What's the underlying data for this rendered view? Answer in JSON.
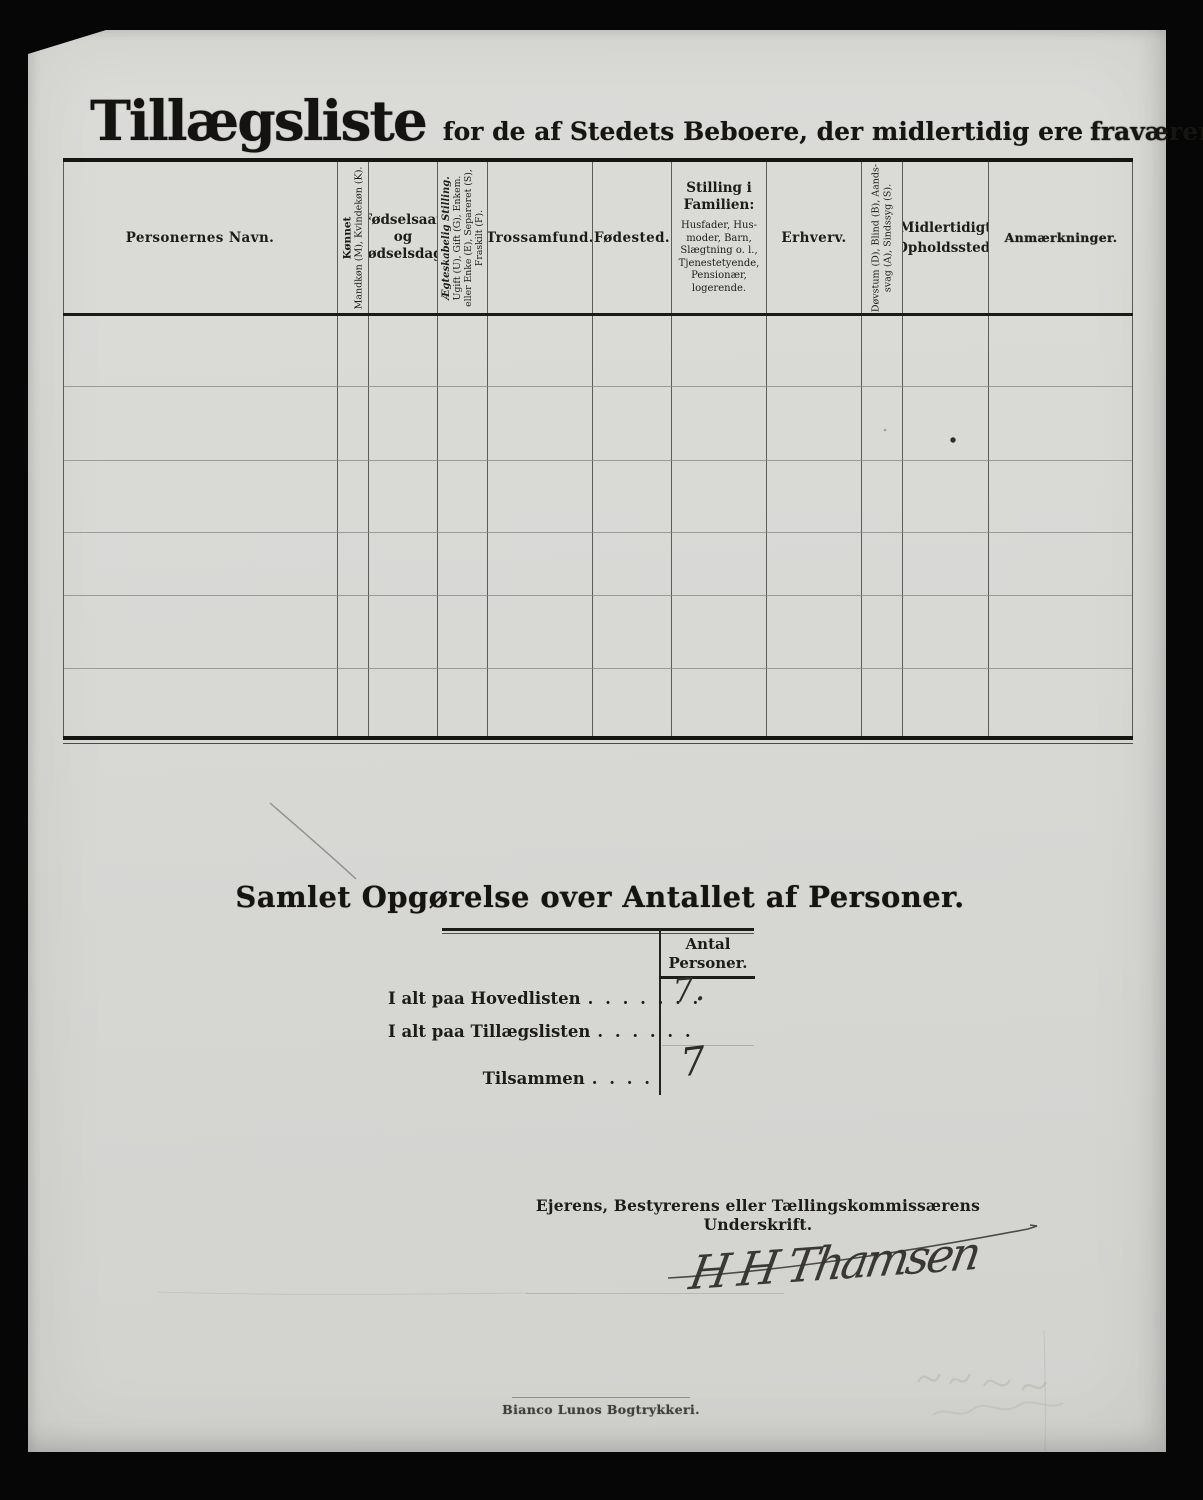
{
  "document": {
    "title": "Tillægsliste",
    "subtitle": "for de af Stedets Beboere, der midlertidig ere",
    "subtitle_emphasis": "fraværende."
  },
  "table": {
    "headers": {
      "name": "Personernes Navn.",
      "sex_title": "Kønnet",
      "sex_detail": "Mandkøn (M), Kvindekøn (K).",
      "birth_line1": "Fødselsaar",
      "birth_line2": "og",
      "birth_line3": "Fødselsdag.",
      "marital_title": "Ægteskabelig Stilling.",
      "marital_line1": "Ugift (U), Gift (G), Enkem.",
      "marital_line2": "eller Enke (E), Separeret (S),",
      "marital_line3": "Fraskilt (F).",
      "religion": "Trossamfund.",
      "birthplace": "Fødested.",
      "family_title_line1": "Stilling i",
      "family_title_line2": "Familien:",
      "family_detail_line1": "Husfader, Hus-",
      "family_detail_line2": "moder, Barn,",
      "family_detail_line3": "Slægtning o. l.,",
      "family_detail_line4": "Tjenestetyende,",
      "family_detail_line5": "Pensionær,",
      "family_detail_line6": "logerende.",
      "occupation": "Erhverv.",
      "disability_line1": "Døvstum (D), Blind (B), Aands-",
      "disability_line2": "svag (A), Sindssyg (S).",
      "temp_residence_line1": "Midlertidigt",
      "temp_residence_line2": "Opholdssted.",
      "remarks": "Anmærkninger."
    },
    "body_rows": 6,
    "body_cols": 11
  },
  "summary": {
    "heading": "Samlet Opgørelse over Antallet af Personer.",
    "col_header_line1": "Antal",
    "col_header_line2": "Personer.",
    "rows": [
      {
        "label": "I alt paa Hovedlisten",
        "dots": ". . . . . . .",
        "value": "7."
      },
      {
        "label": "I alt paa Tillægslisten",
        "dots": ". . . . . .",
        "value": ""
      },
      {
        "label": "Tilsammen",
        "dots": ". . . .",
        "value": "7"
      }
    ]
  },
  "signature_section": {
    "caption": "Ejerens, Bestyrerens eller Tællingskommissærens Underskrift.",
    "signature": "H H Thamsen"
  },
  "footer": {
    "printer": "Bianco Lunos Bogtrykkeri."
  },
  "colors": {
    "paper": "#d8d8d5",
    "ink": "#1d1c1a",
    "surround": "#060606",
    "grid_line": "#5c5c59",
    "row_line": "#9b9b98"
  }
}
